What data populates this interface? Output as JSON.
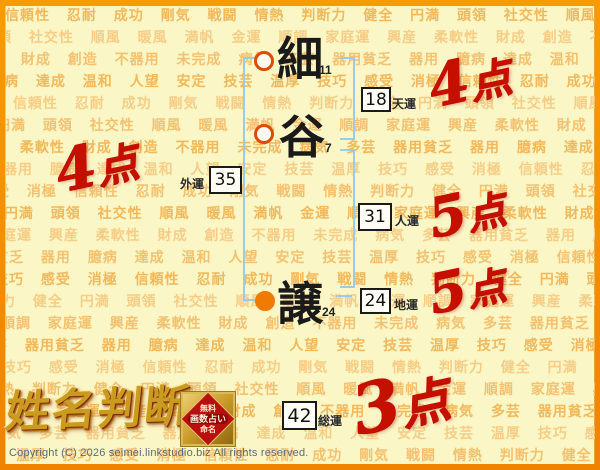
{
  "header": {
    "logo": "姓名判断"
  },
  "badge": {
    "line1": "無料",
    "line2": "画数占い",
    "line3": "命名"
  },
  "name": {
    "chars": [
      {
        "char": "細",
        "strokes": "11",
        "marker": "ring-circle"
      },
      {
        "char": "谷",
        "strokes": "7",
        "marker": "ring-circle"
      },
      {
        "char": "譲",
        "strokes": "24",
        "marker": "filled-circle"
      }
    ]
  },
  "fortunes": [
    {
      "label": "天運",
      "value": "18",
      "score_num": "4",
      "score_unit": "点"
    },
    {
      "label": "外運",
      "value": "35",
      "score_num": "4",
      "score_unit": "点"
    },
    {
      "label": "人運",
      "value": "31",
      "score_num": "5",
      "score_unit": "点"
    },
    {
      "label": "地運",
      "value": "24",
      "score_num": "5",
      "score_unit": "点"
    },
    {
      "label": "総運",
      "value": "42",
      "score_num": "3",
      "score_unit": "点"
    }
  ],
  "footer": {
    "copyright": "Copyright (C) 2026 seimei.linkstudio.biz All rights reserved."
  },
  "watermark": {
    "words": [
      "信頼性",
      "忍耐",
      "成功",
      "剛気",
      "戦闘",
      "情熱",
      "判断力",
      "健全",
      "円満",
      "頭領",
      "社交性",
      "順風",
      "暖風",
      "満帆",
      "金運",
      "順調",
      "家庭運",
      "興産",
      "柔軟性",
      "財成",
      "創造",
      "不器用",
      "未完成",
      "病気",
      "多芸",
      "器用貧乏",
      "器用",
      "臆病",
      "達成",
      "温和",
      "人望",
      "安定",
      "技芸",
      "温厚",
      "技巧",
      "感受",
      "消極"
    ],
    "colors": [
      "#f2b85c",
      "#f6cd86",
      "#f4c170"
    ]
  },
  "colors": {
    "background": "#fbf6c6",
    "border_orange": "#f79400",
    "bracket_blue": "#9ccbe8",
    "score_red": "#c51000",
    "marker_ring": "#dd4a00",
    "marker_fill": "#ef7b00",
    "logo_gold": "#c99c20",
    "badge_red": "#b80f0f"
  }
}
